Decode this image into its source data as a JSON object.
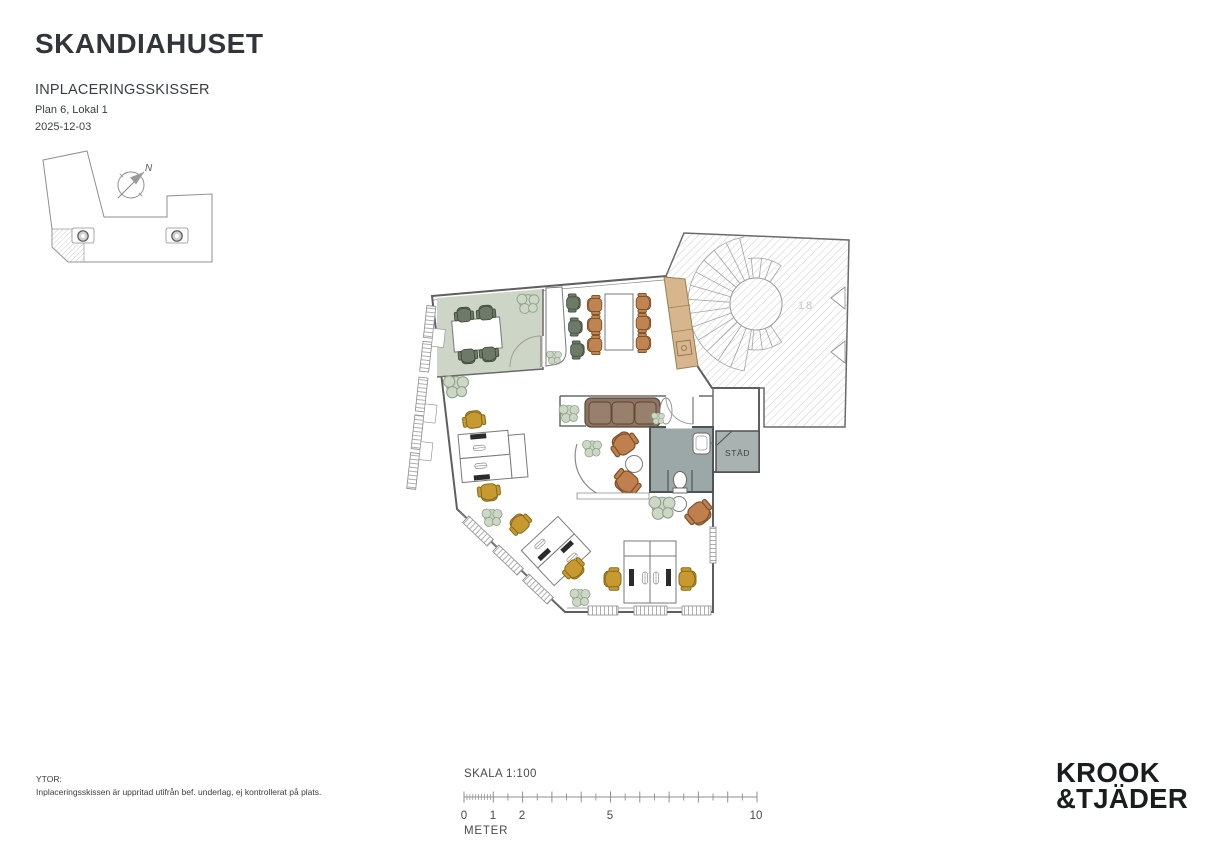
{
  "sheet": {
    "title": "SKANDIAHUSET",
    "subtitle": "INPLACERINGSSKISSER",
    "plan_label": "Plan 6, Lokal 1",
    "date": "2025-12-03"
  },
  "key_plan": {
    "north_label": "N"
  },
  "floor_plan": {
    "labels": {
      "cleaning_room": "STÄD",
      "stairwell_number": "18"
    },
    "colors": {
      "meeting_room_floor": "#cdd5c7",
      "wc_floor": "#9ca8a7",
      "stad_floor": "#a9b2b1",
      "pantry_cabinet": "#d8b68d",
      "sofa": "#8e7362",
      "lounge_chair": "#bf7f4e",
      "dining_chair": "#c08452",
      "task_chair": "#c79a31",
      "meeting_chair": "#6e7a68",
      "plant": "#cdd7c5"
    }
  },
  "footer": {
    "areas_title": "YTOR:",
    "areas_note": "Inplaceringsskissen är uppritad utifrån bef. underlag, ej kontrollerat på plats.",
    "scale_title": "SKALA 1:100",
    "scale_ticks": [
      "0",
      "1",
      "2",
      "5",
      "10"
    ],
    "scale_unit": "METER",
    "logo_line1": "KROOK",
    "logo_line2": "&TJÄDER"
  }
}
